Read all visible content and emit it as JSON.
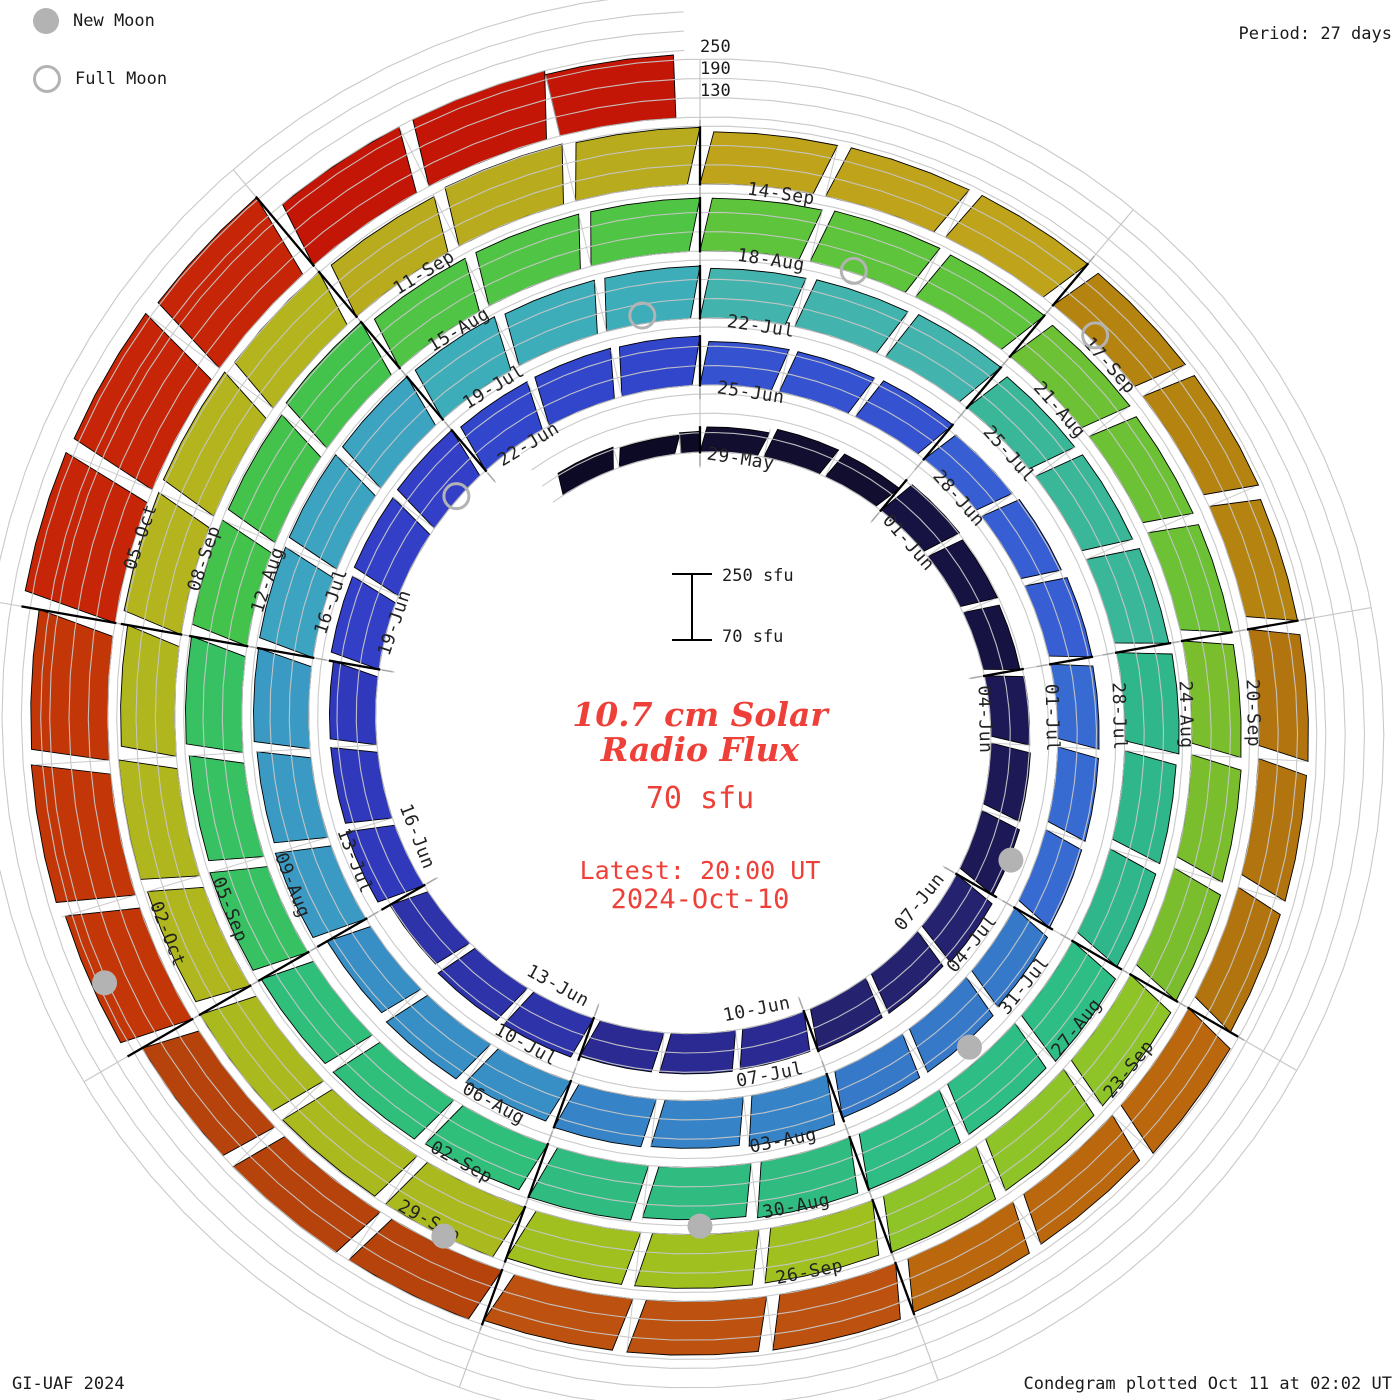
{
  "legend": {
    "new_moon": "New Moon",
    "full_moon": "Full Moon"
  },
  "header": {
    "period": "Period: 27 days"
  },
  "radial_scale_labels": [
    "250",
    "190",
    "130"
  ],
  "center": {
    "scale_top": "250 sfu",
    "scale_bottom": "70 sfu",
    "title_line1": "10.7 cm Solar",
    "title_line2": "Radio Flux",
    "current_value": "70 sfu",
    "latest_line1": "Latest: 20:00 UT",
    "latest_line2": "2024-Oct-10",
    "accent_color": "#ee4038"
  },
  "footer": {
    "left": "GI-UAF 2024",
    "right": "Condegram plotted Oct 11 at 02:02 UT"
  },
  "chart_data": {
    "type": "spiral_bar_condegram",
    "period_days": 27,
    "days_per_segment": 3,
    "flux_base_sfu": 70,
    "flux_gridlines_sfu": [
      130,
      190,
      250
    ],
    "start_date": "27-May",
    "end_date": "10-Oct 20:00 UT",
    "grid_color": "#c6c6c6",
    "moon_marker_color": "#b3b3b3",
    "wedges": [
      {
        "date": "27-May",
        "day": -2.3,
        "flux": 135,
        "color": "#0c0a24",
        "labeled": false
      },
      {
        "date": "29-May",
        "day": 0,
        "flux": 155,
        "color": "#110e30",
        "labeled": true
      },
      {
        "date": "01-Jun",
        "day": 3,
        "flux": 185,
        "color": "#161343",
        "labeled": true
      },
      {
        "date": "04-Jun",
        "day": 6,
        "flux": 196,
        "color": "#1d1856",
        "labeled": true
      },
      {
        "date": "07-Jun",
        "day": 9,
        "flux": 206,
        "color": "#252270",
        "labeled": true
      },
      {
        "date": "10-Jun",
        "day": 12,
        "flux": 196,
        "color": "#2a2a92",
        "labeled": true
      },
      {
        "date": "13-Jun",
        "day": 15,
        "flux": 200,
        "color": "#2e33aa",
        "labeled": true
      },
      {
        "date": "16-Jun",
        "day": 18,
        "flux": 212,
        "color": "#3039bc",
        "labeled": true
      },
      {
        "date": "19-Jun",
        "day": 21,
        "flux": 228,
        "color": "#333fc6",
        "labeled": true
      },
      {
        "date": "22-Jun",
        "day": 24,
        "flux": 220,
        "color": "#3146cb",
        "labeled": true
      },
      {
        "date": "25-Jun",
        "day": 27,
        "flux": 206,
        "color": "#3552d0",
        "labeled": true
      },
      {
        "date": "28-Jun",
        "day": 30,
        "flux": 196,
        "color": "#375ed2",
        "labeled": true
      },
      {
        "date": "01-Jul",
        "day": 33,
        "flux": 192,
        "color": "#386bd2",
        "labeled": true
      },
      {
        "date": "04-Jul",
        "day": 36,
        "flux": 206,
        "color": "#3779c9",
        "labeled": true
      },
      {
        "date": "07-Jul",
        "day": 39,
        "flux": 224,
        "color": "#3684c7",
        "labeled": true
      },
      {
        "date": "10-Jul",
        "day": 42,
        "flux": 214,
        "color": "#388fc5",
        "labeled": true
      },
      {
        "date": "13-Jul",
        "day": 45,
        "flux": 238,
        "color": "#3a9ac3",
        "labeled": true
      },
      {
        "date": "16-Jul",
        "day": 48,
        "flux": 240,
        "color": "#3ca3c1",
        "labeled": true
      },
      {
        "date": "19-Jul",
        "day": 51,
        "flux": 234,
        "color": "#3eadba",
        "labeled": true
      },
      {
        "date": "22-Jul",
        "day": 54,
        "flux": 226,
        "color": "#43b4ad",
        "labeled": true
      },
      {
        "date": "25-Jul",
        "day": 57,
        "flux": 230,
        "color": "#3ab798",
        "labeled": true
      },
      {
        "date": "28-Jul",
        "day": 60,
        "flux": 236,
        "color": "#2fb78b",
        "labeled": true
      },
      {
        "date": "31-Jul",
        "day": 63,
        "flux": 240,
        "color": "#2ebd85",
        "labeled": true
      },
      {
        "date": "03-Aug",
        "day": 66,
        "flux": 236,
        "color": "#30bc80",
        "labeled": true
      },
      {
        "date": "06-Aug",
        "day": 69,
        "flux": 232,
        "color": "#30bf7a",
        "labeled": true
      },
      {
        "date": "09-Aug",
        "day": 72,
        "flux": 240,
        "color": "#38c163",
        "labeled": true
      },
      {
        "date": "12-Aug",
        "day": 75,
        "flux": 250,
        "color": "#44c34c",
        "labeled": true
      },
      {
        "date": "15-Aug",
        "day": 78,
        "flux": 242,
        "color": "#50c444",
        "labeled": true
      },
      {
        "date": "18-Aug",
        "day": 81,
        "flux": 232,
        "color": "#5ec43c",
        "labeled": true
      },
      {
        "date": "21-Aug",
        "day": 84,
        "flux": 226,
        "color": "#6cc134",
        "labeled": true
      },
      {
        "date": "24-Aug",
        "day": 87,
        "flux": 230,
        "color": "#7abe2e",
        "labeled": true
      },
      {
        "date": "27-Aug",
        "day": 90,
        "flux": 240,
        "color": "#8ec428",
        "labeled": true
      },
      {
        "date": "30-Aug",
        "day": 93,
        "flux": 236,
        "color": "#a0c020",
        "labeled": true
      },
      {
        "date": "02-Sep",
        "day": 96,
        "flux": 246,
        "color": "#aaba1e",
        "labeled": true
      },
      {
        "date": "05-Sep",
        "day": 99,
        "flux": 242,
        "color": "#b0b61e",
        "labeled": true
      },
      {
        "date": "08-Sep",
        "day": 102,
        "flux": 252,
        "color": "#b4b41e",
        "labeled": true
      },
      {
        "date": "11-Sep",
        "day": 105,
        "flux": 246,
        "color": "#b8ab1d",
        "labeled": true
      },
      {
        "date": "14-Sep",
        "day": 108,
        "flux": 236,
        "color": "#bfa31b",
        "labeled": true
      },
      {
        "date": "17-Sep",
        "day": 111,
        "flux": 230,
        "color": "#b5830f",
        "labeled": true
      },
      {
        "date": "20-Sep",
        "day": 114,
        "flux": 226,
        "color": "#b2740f",
        "labeled": true
      },
      {
        "date": "23-Sep",
        "day": 117,
        "flux": 236,
        "color": "#bb670e",
        "labeled": true
      },
      {
        "date": "26-Sep",
        "day": 120,
        "flux": 242,
        "color": "#bc5110",
        "labeled": true
      },
      {
        "date": "29-Sep",
        "day": 123,
        "flux": 252,
        "color": "#b5430b",
        "labeled": true
      },
      {
        "date": "02-Oct",
        "day": 126,
        "flux": 310,
        "color": "#c33608",
        "labeled": true
      },
      {
        "date": "05-Oct",
        "day": 129,
        "flux": 360,
        "color": "#c62507",
        "labeled": true
      },
      {
        "date": "08-Oct",
        "day": 132,
        "flux": 272,
        "color": "#c41606",
        "labeled": false
      }
    ],
    "end_day": 134.83,
    "moons": [
      {
        "date": "06-Jun",
        "type": "new",
        "day": 8.5,
        "flux": 205
      },
      {
        "date": "21-Jun",
        "type": "full",
        "day": 23.5,
        "flux": 78
      },
      {
        "date": "05-Jul",
        "type": "new",
        "day": 37.5,
        "flux": 232
      },
      {
        "date": "21-Jul",
        "type": "full",
        "day": 53.4,
        "flux": 95
      },
      {
        "date": "04-Aug",
        "type": "new",
        "day": 67.5,
        "flux": 252
      },
      {
        "date": "19-Aug",
        "type": "full",
        "day": 82.4,
        "flux": 76
      },
      {
        "date": "02-Sep",
        "type": "new",
        "day": 96.5,
        "flux": 248
      },
      {
        "date": "17-Sep",
        "type": "full",
        "day": 111.4,
        "flux": 86
      },
      {
        "date": "02-Oct",
        "type": "new",
        "day": 126.5,
        "flux": 258
      }
    ]
  }
}
